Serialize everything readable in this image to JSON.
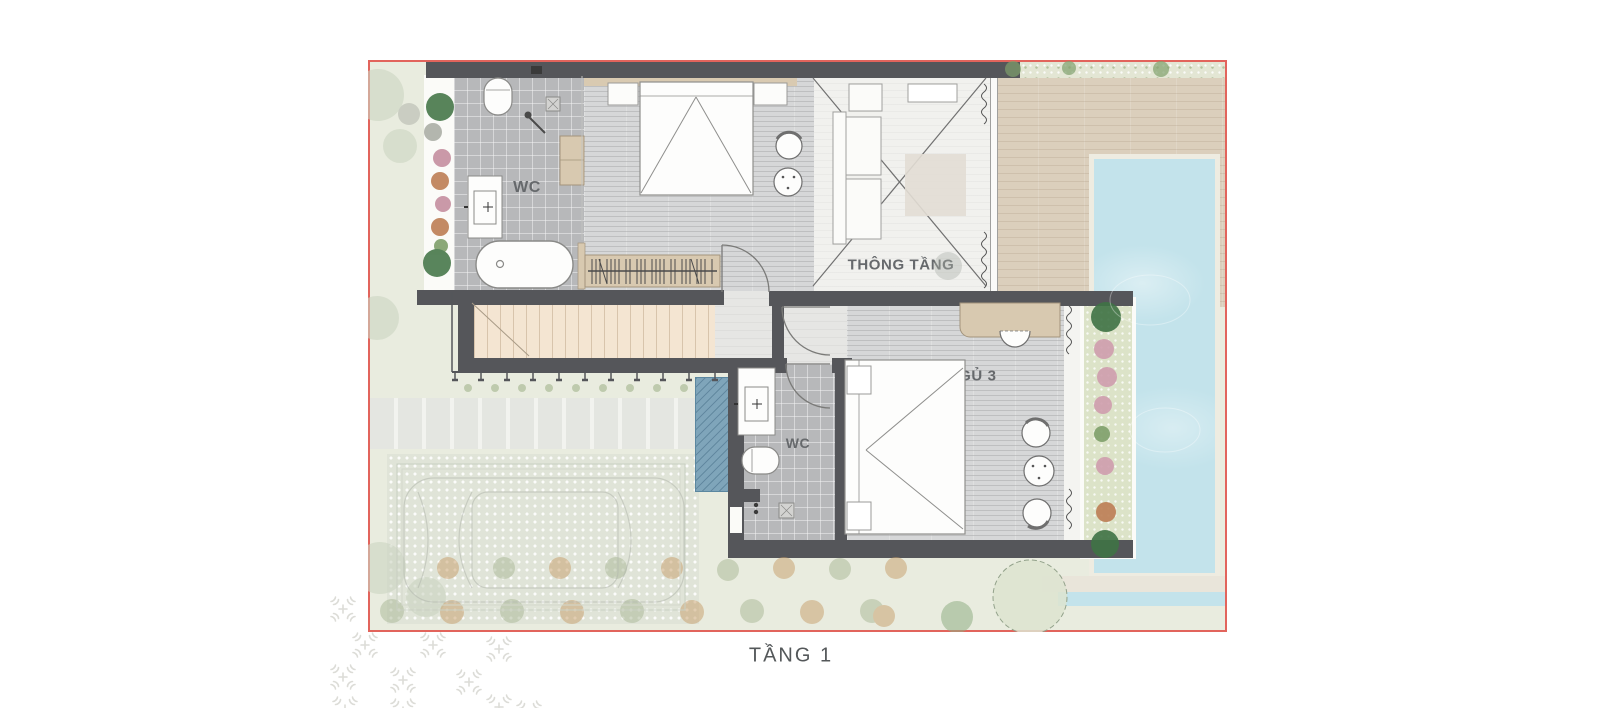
{
  "floor_plan": {
    "caption": "TẦNG 1",
    "rooms": [
      {
        "name": "wc-master",
        "label": "WC"
      },
      {
        "name": "bedroom-2",
        "label": "P. NGỦ 2"
      },
      {
        "name": "void-space",
        "label": "THÔNG TẦNG"
      },
      {
        "name": "bedroom-3",
        "label": "P. NGỦ 3"
      },
      {
        "name": "wc-bedroom-3",
        "label": "WC"
      }
    ],
    "colors": {
      "plan_border": "#e2645c",
      "wall": "#55565a",
      "pool_water": "#c3e3eb",
      "deck_wood": "#dbcfbc",
      "stair_wood": "#f4e5d2",
      "garden": "#e9ecdf",
      "water_feature": "#7fa5ba",
      "furniture_wood": "#d8c9b0",
      "label_text": "#66696c"
    }
  }
}
